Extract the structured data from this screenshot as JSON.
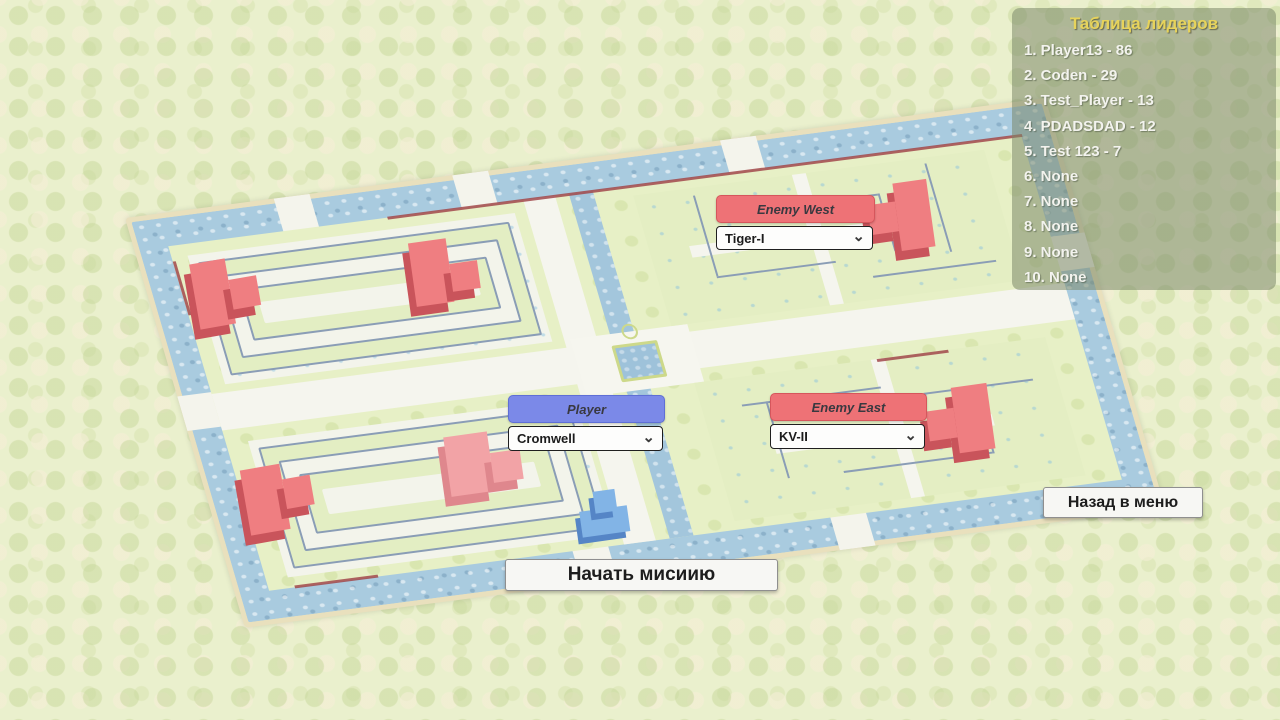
{
  "leaderboard": {
    "title": "Таблица лидеров",
    "entries": [
      "1. Player13 - 86",
      "2. Coden - 29",
      "3. Test_Player - 13",
      "4. PDADSDAD - 12",
      "5. Test 123 - 7",
      "6. None",
      "7. None",
      "8. None",
      "9. None",
      "10. None"
    ]
  },
  "panels": {
    "enemy_west": {
      "label": "Enemy West",
      "selected_tank": "Tiger-I"
    },
    "player": {
      "label": "Player",
      "selected_tank": "Cromwell"
    },
    "enemy_east": {
      "label": "Enemy East",
      "selected_tank": "KV-II"
    }
  },
  "buttons": {
    "start_mission": "Начать мисиию",
    "back_to_menu": "Назад в меню"
  },
  "icons": {
    "chevron_down": "⌄"
  },
  "colors": {
    "enemy_header": "#ee7276",
    "player_header": "#7b89e8",
    "enemy_tank": "#ef7e81",
    "player_tank": "#82b4e6",
    "leaderboard_title": "#e7d35b",
    "water": "#a9cbdf"
  }
}
